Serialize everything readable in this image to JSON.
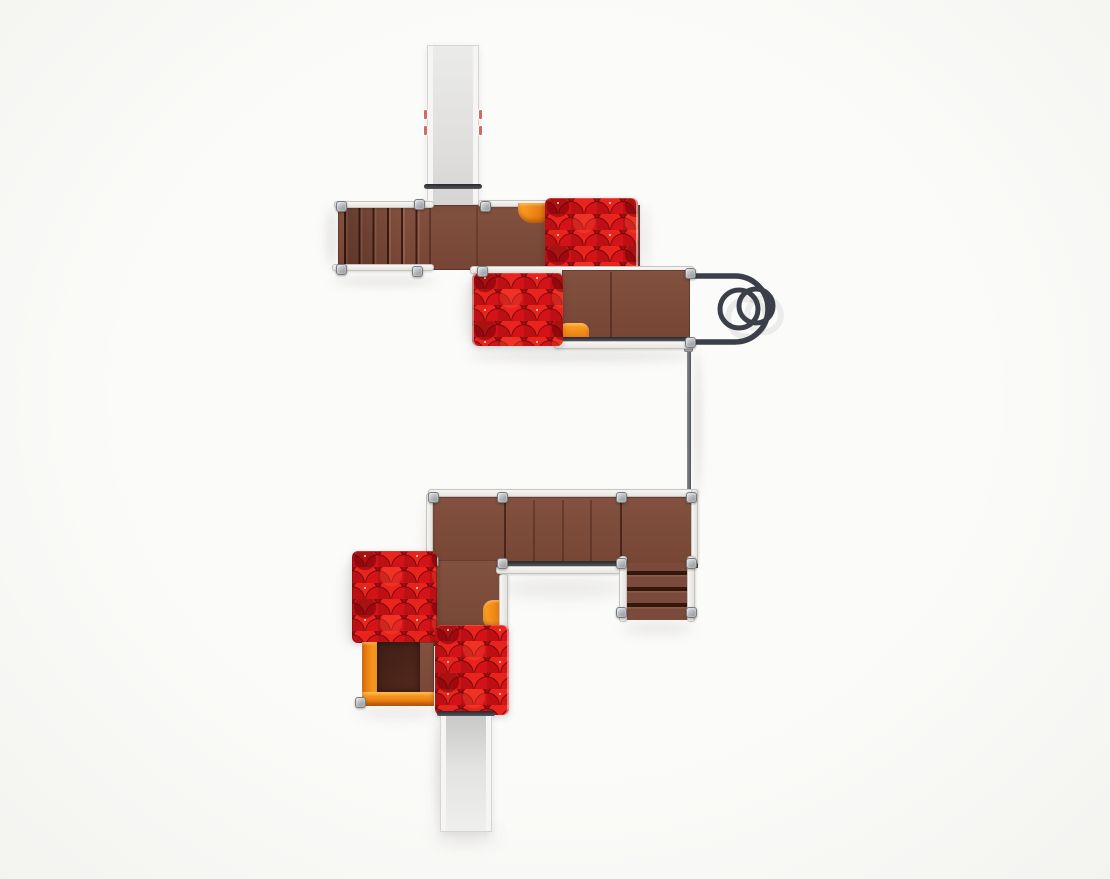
{
  "meta": {
    "scene": "Top-down 3D render of a modular playground structure on a white studio background",
    "visible_text": ""
  },
  "palette": {
    "bg": "#fbfbf9",
    "bgedge": "#f3f3f0",
    "deck": "#7c4a3a",
    "deckdark": "#64382c",
    "roofbase": "#9c0c10",
    "roofa": "#d31318",
    "roofb": "#bc1015",
    "roofc": "#e8241c",
    "roofdark": "rgba(105,0,6,0.5)",
    "roofbright": "rgba(255,80,55,0.33)",
    "nail": "rgba(255,228,218,0.9)",
    "orange": "#ef7d12",
    "orangelight": "#ffa524",
    "orangedark": "#e06d0c",
    "railwhite": "#f3f2ef",
    "postgrey": "#b9bcbe",
    "tube": "#3a3f49",
    "pole": "#6a6e74",
    "slidegrey": "#dddddb",
    "sliderail": "#f6f5f3",
    "shadow": "rgba(60,50,45,0.10)"
  },
  "components": [
    {
      "id": "upper-slide",
      "label": "Upper straight slide (grey, exits top)"
    },
    {
      "id": "safety-bar",
      "label": "Slide entry safety bar"
    },
    {
      "id": "upper-stairs",
      "label": "Upper access stairs"
    },
    {
      "id": "upper-deck",
      "label": "Upper platform deck"
    },
    {
      "id": "upper-roof",
      "label": "Red shingle roof - upper tower"
    },
    {
      "id": "upper-slide-hood",
      "label": "Orange slide hood (upper deck)"
    },
    {
      "id": "middle-roof",
      "label": "Red shingle roof - middle tower"
    },
    {
      "id": "middle-deck",
      "label": "Middle platform deck"
    },
    {
      "id": "middle-slide-hood",
      "label": "Orange slide hood (middle deck)"
    },
    {
      "id": "loop-climber",
      "label": "Steel loop climber with double rings"
    },
    {
      "id": "connecting-beam",
      "label": "Connecting beam between towers"
    },
    {
      "id": "lower-deck",
      "label": "Lower platform deck"
    },
    {
      "id": "lower-stairs",
      "label": "Lower access stairs"
    },
    {
      "id": "lower-roof-left",
      "label": "Red shingle roof - lower left tower"
    },
    {
      "id": "crawl-box",
      "label": "Orange crawl box opening"
    },
    {
      "id": "lower-roof-right",
      "label": "Red shingle roof - lower right tower"
    },
    {
      "id": "lower-slide-hood",
      "label": "Orange slide hood (lower deck)"
    },
    {
      "id": "lower-slide",
      "label": "Lower straight slide (grey, exits bottom)"
    }
  ]
}
